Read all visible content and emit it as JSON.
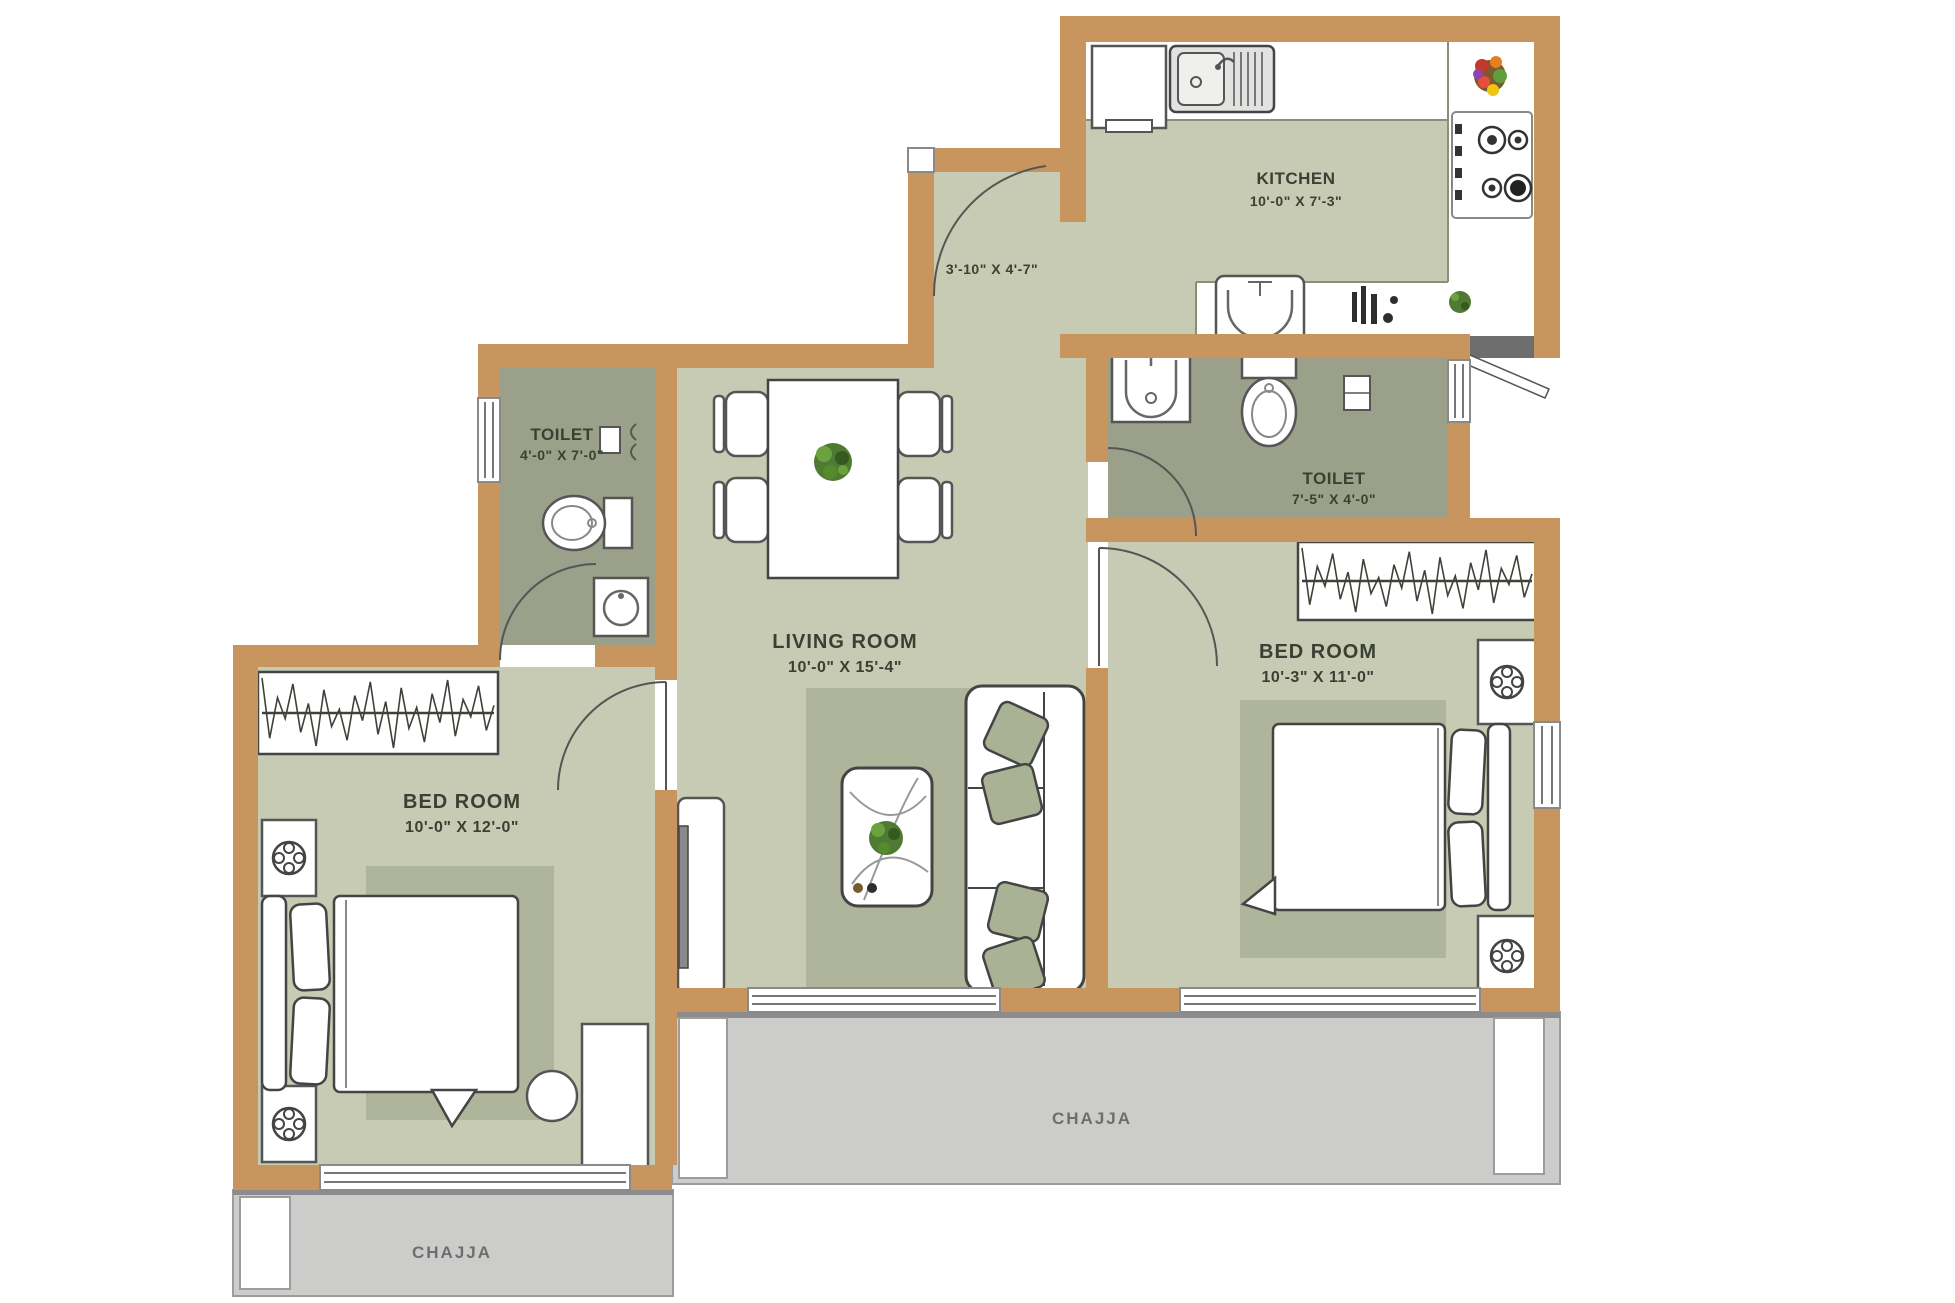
{
  "title": "Apartment Floor Plan",
  "colors": {
    "wall": "#c8955e",
    "floor": "#c8cbb3",
    "rug": "#aeb59b",
    "toilet_floor": "#9aa089",
    "chajja": "#cccdca",
    "counter": "#ffffff",
    "outline": "#4e5146",
    "label_text": "#3a4033",
    "chajja_text": "#6e6e6e",
    "pillow": "#a9b295",
    "plant": "#4e7a33"
  },
  "rooms": {
    "kitchen": {
      "name": "KITCHEN",
      "dims": "10'-0\" X 7'-3\""
    },
    "passage": {
      "dims": "3'-10\" X 4'-7\""
    },
    "toilet_left": {
      "name": "TOILET",
      "dims": "4'-0\" X 7'-0\""
    },
    "toilet_right": {
      "name": "TOILET",
      "dims": "7'-5\" X 4'-0\""
    },
    "living_room": {
      "name": "LIVING ROOM",
      "dims": "10'-0\" X 15'-4\""
    },
    "bedroom_left": {
      "name": "BED ROOM",
      "dims": "10'-0\" X 12'-0\""
    },
    "bedroom_right": {
      "name": "BED ROOM",
      "dims": "10'-3\" X 11'-0\""
    },
    "chajja_center": {
      "name": "CHAJJA"
    },
    "chajja_left": {
      "name": "CHAJJA"
    }
  }
}
